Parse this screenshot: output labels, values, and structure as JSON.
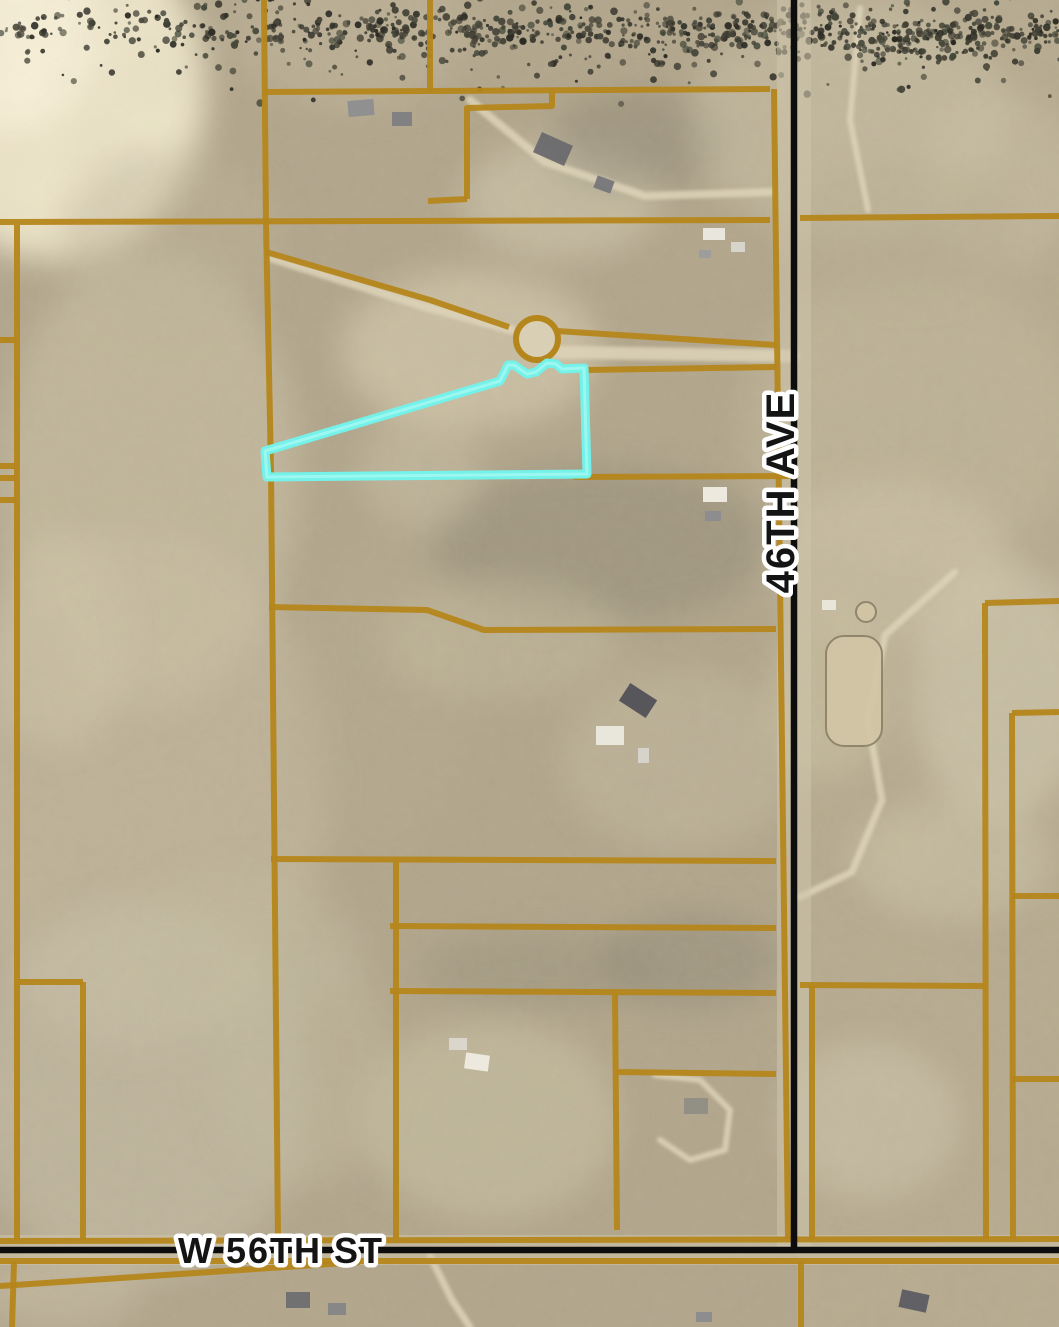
{
  "map": {
    "width": 1059,
    "height": 1327,
    "colors": {
      "terrain_base": "#b2a68c",
      "east_tint": "#c8bda0",
      "parcel_line": "#b5861b",
      "subject_outline": "#74f2ea",
      "subject_outline_inner": "#aefaf4",
      "road_black": "#0d0d0d",
      "pavement": "#cdc5ab",
      "dirt_path": "#ddd3b8",
      "culdesac_fill": "#d9cfb4",
      "label_fill": "#141414",
      "label_halo": "#ffffff",
      "arena_fill": "#d2c6a6",
      "arena_edge": "#8a8168"
    },
    "roads": {
      "ave": {
        "label": "46TH AVE",
        "x": 794,
        "y_start": 0,
        "y_end": 1253,
        "line_width": 6.5,
        "label_x": 794,
        "label_y": 492,
        "label_size": 40
      },
      "st": {
        "label": "W 56TH ST",
        "y": 1250,
        "x_start": 0,
        "x_end": 1059,
        "line_width": 6.5,
        "label_x": 178,
        "label_y": 1263,
        "label_size": 36
      }
    },
    "subject_parcel": {
      "points": [
        [
          265,
          451
        ],
        [
          500,
          381
        ],
        [
          508,
          365
        ],
        [
          514,
          365
        ],
        [
          527,
          374
        ],
        [
          536,
          372
        ],
        [
          547,
          363
        ],
        [
          556,
          364
        ],
        [
          562,
          369
        ],
        [
          584,
          368
        ],
        [
          587,
          474
        ],
        [
          267,
          477
        ]
      ],
      "stroke_width": 9
    },
    "culdesac": {
      "cx": 537,
      "cy": 339,
      "r": 21
    },
    "arena": {
      "x": 826,
      "y": 636,
      "w": 56,
      "h": 110,
      "rx": 18,
      "pen_cx": 866,
      "pen_cy": 612,
      "pen_r": 10
    },
    "parcel_lines": [
      [
        [
          0,
          222
        ],
        [
          770,
          220
        ]
      ],
      [
        [
          800,
          218
        ],
        [
          1059,
          216
        ]
      ],
      [
        [
          264,
          0
        ],
        [
          266,
          224
        ]
      ],
      [
        [
          266,
          224
        ],
        [
          271,
          470
        ],
        [
          278,
          1240
        ]
      ],
      [
        [
          430,
          0
        ],
        [
          430,
          92
        ]
      ],
      [
        [
          264,
          92
        ],
        [
          770,
          89
        ]
      ],
      [
        [
          467,
          199
        ],
        [
          467,
          108
        ],
        [
          552,
          106
        ],
        [
          552,
          91
        ]
      ],
      [
        [
          428,
          201
        ],
        [
          467,
          199
        ]
      ],
      [
        [
          266,
          252
        ],
        [
          430,
          300
        ],
        [
          509,
          327
        ]
      ],
      [
        [
          557,
          331
        ],
        [
          776,
          345
        ]
      ],
      [
        [
          586,
          370
        ],
        [
          776,
          367
        ]
      ],
      [
        [
          573,
          477
        ],
        [
          794,
          476
        ]
      ],
      [
        [
          774,
          89
        ],
        [
          788,
          1239
        ]
      ],
      [
        [
          269,
          607
        ],
        [
          427,
          610
        ],
        [
          484,
          630
        ],
        [
          776,
          629
        ]
      ],
      [
        [
          271,
          859
        ],
        [
          776,
          861
        ]
      ],
      [
        [
          390,
          926
        ],
        [
          776,
          928
        ]
      ],
      [
        [
          396,
          861
        ],
        [
          396,
          1238
        ]
      ],
      [
        [
          390,
          991
        ],
        [
          776,
          993
        ]
      ],
      [
        [
          615,
          994
        ],
        [
          617,
          1230
        ]
      ],
      [
        [
          617,
          1072
        ],
        [
          776,
          1074
        ]
      ],
      [
        [
          0,
          1241
        ],
        [
          1059,
          1239
        ]
      ],
      [
        [
          0,
          1261
        ],
        [
          1059,
          1261
        ]
      ],
      [
        [
          0,
          1286
        ],
        [
          360,
          1262
        ]
      ],
      [
        [
          14,
          1262
        ],
        [
          12,
          1327
        ]
      ],
      [
        [
          801,
          1262
        ],
        [
          801,
          1327
        ]
      ],
      [
        [
          985,
          603
        ],
        [
          1059,
          601
        ]
      ],
      [
        [
          985,
          603
        ],
        [
          986,
          1239
        ]
      ],
      [
        [
          1012,
          713
        ],
        [
          1059,
          712
        ]
      ],
      [
        [
          1012,
          713
        ],
        [
          1013,
          1239
        ]
      ],
      [
        [
          1012,
          896
        ],
        [
          1059,
          896
        ]
      ],
      [
        [
          1012,
          1079
        ],
        [
          1059,
          1079
        ]
      ],
      [
        [
          800,
          985
        ],
        [
          985,
          986
        ]
      ],
      [
        [
          812,
          986
        ],
        [
          812,
          1239
        ]
      ],
      [
        [
          0,
          340
        ],
        [
          17,
          340
        ]
      ],
      [
        [
          0,
          466
        ],
        [
          17,
          466
        ]
      ],
      [
        [
          0,
          478
        ],
        [
          17,
          478
        ]
      ],
      [
        [
          0,
          500
        ],
        [
          17,
          500
        ]
      ],
      [
        [
          17,
          225
        ],
        [
          17,
          1241
        ]
      ],
      [
        [
          18,
          982
        ],
        [
          83,
          982
        ]
      ],
      [
        [
          83,
          982
        ],
        [
          83,
          1240
        ]
      ]
    ],
    "paths": [
      {
        "pts": [
          [
            272,
            258
          ],
          [
            420,
            305
          ],
          [
            512,
            330
          ]
        ],
        "w": 9
      },
      {
        "pts": [
          [
            549,
            352
          ],
          [
            793,
            356
          ]
        ],
        "w": 13
      },
      {
        "pts": [
          [
            470,
            100
          ],
          [
            545,
            162
          ],
          [
            645,
            196
          ],
          [
            772,
            192
          ]
        ],
        "w": 8
      },
      {
        "pts": [
          [
            955,
            572
          ],
          [
            885,
            635
          ],
          [
            868,
            720
          ],
          [
            882,
            800
          ],
          [
            852,
            872
          ],
          [
            800,
            897
          ]
        ],
        "w": 7
      },
      {
        "pts": [
          [
            860,
            8
          ],
          [
            850,
            120
          ],
          [
            868,
            210
          ]
        ],
        "w": 6
      },
      {
        "pts": [
          [
            655,
            1075
          ],
          [
            700,
            1080
          ],
          [
            730,
            1110
          ],
          [
            725,
            1150
          ],
          [
            690,
            1160
          ],
          [
            660,
            1140
          ]
        ],
        "w": 6
      },
      {
        "pts": [
          [
            430,
            1256
          ],
          [
            452,
            1300
          ],
          [
            470,
            1327
          ]
        ],
        "w": 7
      }
    ],
    "patches": [
      [
        55,
        90,
        150,
        170,
        "#efe7cb",
        0.95
      ],
      [
        10,
        30,
        90,
        100,
        "#f7f0d8",
        0.9
      ],
      [
        150,
        480,
        150,
        230,
        "#cfc5a9",
        0.5
      ],
      [
        140,
        790,
        190,
        260,
        "#cbc2a7",
        0.45
      ],
      [
        140,
        1090,
        170,
        190,
        "#c9c2ab",
        0.5
      ],
      [
        470,
        350,
        130,
        80,
        "#d8cfb3",
        0.6
      ],
      [
        560,
        200,
        100,
        60,
        "#d6cdb4",
        0.5
      ],
      [
        640,
        140,
        90,
        50,
        "#8f8776",
        0.5
      ],
      [
        600,
        545,
        170,
        80,
        "#8e8774",
        0.45
      ],
      [
        910,
        420,
        170,
        150,
        "#c3b99e",
        0.5
      ],
      [
        1000,
        690,
        90,
        130,
        "#d6cdb4",
        0.55
      ],
      [
        890,
        560,
        120,
        80,
        "#cfc6ab",
        0.5
      ],
      [
        490,
        1120,
        130,
        100,
        "#cbc2a6",
        0.55
      ],
      [
        300,
        1060,
        90,
        130,
        "#c3bb9f",
        0.45
      ],
      [
        680,
        760,
        120,
        90,
        "#c9c0a5",
        0.4
      ],
      [
        380,
        700,
        90,
        160,
        "#b7ad92",
        0.4
      ],
      [
        850,
        120,
        160,
        120,
        "#cfc6ab",
        0.45
      ],
      [
        1000,
        180,
        80,
        90,
        "#c9c0a6",
        0.5
      ],
      [
        870,
        1120,
        90,
        80,
        "#cfc8b0",
        0.5
      ],
      [
        60,
        1290,
        80,
        40,
        "#c9c0a8",
        0.5
      ],
      [
        350,
        30,
        120,
        80,
        "#c3b99e",
        0.45
      ],
      [
        690,
        960,
        90,
        50,
        "#8e8775",
        0.45
      ],
      [
        540,
        970,
        120,
        40,
        "#938b78",
        0.4
      ],
      [
        240,
        950,
        120,
        80,
        "#c3bb9f",
        0.4
      ],
      [
        420,
        470,
        60,
        60,
        "#c9c0a5",
        0.5
      ],
      [
        830,
        690,
        60,
        90,
        "#c9bfa0",
        0.6
      ],
      [
        950,
        860,
        100,
        60,
        "#cfc7ac",
        0.5
      ],
      [
        170,
        240,
        110,
        90,
        "#bdb398",
        0.4
      ],
      [
        60,
        640,
        70,
        110,
        "#cfc6aa",
        0.5
      ],
      [
        500,
        640,
        120,
        60,
        "#c5bca0",
        0.45
      ],
      [
        900,
        230,
        120,
        70,
        "#b7ad92",
        0.4
      ]
    ],
    "tree_clusters": [
      [
        900,
        40,
        45,
        25,
        26
      ],
      [
        965,
        55,
        40,
        22,
        22
      ],
      [
        1025,
        45,
        35,
        20,
        18
      ],
      [
        1045,
        105,
        25,
        30,
        16
      ],
      [
        855,
        90,
        25,
        18,
        12
      ],
      [
        835,
        265,
        35,
        25,
        20
      ],
      [
        885,
        305,
        45,
        28,
        26
      ],
      [
        950,
        345,
        45,
        28,
        26
      ],
      [
        1015,
        385,
        40,
        26,
        22
      ],
      [
        1050,
        430,
        25,
        20,
        14
      ],
      [
        870,
        360,
        30,
        20,
        14
      ],
      [
        935,
        415,
        30,
        20,
        14
      ],
      [
        1040,
        990,
        18,
        35,
        20
      ],
      [
        1038,
        1055,
        16,
        40,
        22
      ],
      [
        1045,
        1115,
        16,
        30,
        16
      ],
      [
        272,
        45,
        12,
        45,
        18
      ],
      [
        350,
        115,
        30,
        18,
        14
      ],
      [
        425,
        120,
        20,
        14,
        10
      ],
      [
        330,
        250,
        35,
        15,
        12
      ],
      [
        395,
        262,
        35,
        14,
        12
      ],
      [
        455,
        275,
        30,
        14,
        10
      ],
      [
        670,
        150,
        45,
        30,
        26
      ],
      [
        715,
        205,
        30,
        22,
        16
      ],
      [
        625,
        235,
        25,
        15,
        10
      ],
      [
        470,
        555,
        40,
        25,
        20
      ],
      [
        540,
        530,
        40,
        28,
        22
      ],
      [
        610,
        505,
        40,
        28,
        22
      ],
      [
        680,
        480,
        40,
        25,
        20
      ],
      [
        645,
        565,
        35,
        22,
        16
      ],
      [
        730,
        525,
        30,
        22,
        16
      ],
      [
        755,
        575,
        25,
        18,
        12
      ],
      [
        705,
        600,
        25,
        15,
        10
      ],
      [
        310,
        645,
        18,
        30,
        14
      ],
      [
        330,
        710,
        18,
        35,
        16
      ],
      [
        350,
        780,
        18,
        35,
        16
      ],
      [
        365,
        850,
        16,
        30,
        14
      ],
      [
        378,
        915,
        14,
        25,
        12
      ],
      [
        625,
        645,
        35,
        18,
        14
      ],
      [
        690,
        655,
        30,
        15,
        10
      ],
      [
        510,
        795,
        35,
        20,
        16
      ],
      [
        570,
        820,
        35,
        20,
        16
      ],
      [
        625,
        835,
        30,
        18,
        12
      ],
      [
        470,
        760,
        25,
        18,
        10
      ],
      [
        470,
        950,
        35,
        18,
        14
      ],
      [
        560,
        950,
        40,
        18,
        16
      ],
      [
        640,
        950,
        35,
        18,
        14
      ],
      [
        720,
        945,
        30,
        18,
        12
      ],
      [
        420,
        1005,
        20,
        12,
        8
      ],
      [
        600,
        1020,
        25,
        12,
        8
      ],
      [
        125,
        1200,
        30,
        14,
        18
      ],
      [
        185,
        1202,
        30,
        14,
        18
      ],
      [
        240,
        1202,
        28,
        14,
        16
      ],
      [
        90,
        1190,
        18,
        12,
        10
      ],
      [
        870,
        1060,
        60,
        60,
        60
      ],
      [
        930,
        1140,
        55,
        60,
        55
      ],
      [
        860,
        1180,
        45,
        45,
        40
      ],
      [
        940,
        1030,
        40,
        35,
        30
      ],
      [
        830,
        1110,
        30,
        50,
        30
      ],
      [
        510,
        1300,
        40,
        18,
        16
      ],
      [
        580,
        1312,
        40,
        16,
        16
      ],
      [
        650,
        1318,
        35,
        14,
        12
      ],
      [
        915,
        1300,
        45,
        25,
        22
      ],
      [
        460,
        1290,
        20,
        12,
        8
      ],
      [
        820,
        800,
        15,
        40,
        14
      ],
      [
        812,
        880,
        12,
        25,
        10
      ],
      [
        170,
        130,
        30,
        20,
        8
      ],
      [
        90,
        420,
        15,
        25,
        8
      ],
      [
        45,
        540,
        12,
        20,
        6
      ],
      [
        660,
        1100,
        25,
        15,
        10
      ],
      [
        745,
        1140,
        20,
        15,
        8
      ],
      [
        700,
        1230,
        25,
        15,
        10
      ],
      [
        560,
        1240,
        30,
        10,
        8
      ],
      [
        430,
        485,
        70,
        12,
        16
      ],
      [
        540,
        490,
        40,
        10,
        10
      ],
      [
        745,
        70,
        20,
        15,
        8
      ],
      [
        600,
        60,
        25,
        15,
        6
      ]
    ],
    "buildings": [
      [
        348,
        100,
        26,
        16,
        "#8e8e90",
        -5
      ],
      [
        392,
        112,
        20,
        14,
        "#7e7e82",
        0
      ],
      [
        536,
        138,
        34,
        22,
        "#6a6a6e",
        24
      ],
      [
        595,
        178,
        18,
        13,
        "#76767a",
        20
      ],
      [
        703,
        228,
        22,
        12,
        "#eceae2",
        0
      ],
      [
        731,
        242,
        14,
        10,
        "#d9d7cf",
        0
      ],
      [
        699,
        250,
        12,
        8,
        "#9c9c9e",
        0
      ],
      [
        703,
        487,
        24,
        15,
        "#f0ede3",
        0
      ],
      [
        705,
        511,
        16,
        10,
        "#8c8c90",
        0
      ],
      [
        622,
        690,
        32,
        21,
        "#515157",
        33
      ],
      [
        596,
        726,
        28,
        19,
        "#ebe9df",
        0
      ],
      [
        638,
        748,
        11,
        15,
        "#d7d5cc",
        0
      ],
      [
        449,
        1038,
        18,
        12,
        "#dbd8cd",
        0
      ],
      [
        465,
        1054,
        24,
        16,
        "#f0ece2",
        8
      ],
      [
        684,
        1098,
        24,
        16,
        "#908d85",
        0
      ],
      [
        822,
        600,
        14,
        10,
        "#eae7dc",
        0
      ],
      [
        286,
        1292,
        24,
        16,
        "#6e6e70",
        0
      ],
      [
        328,
        1303,
        18,
        12,
        "#858587",
        0
      ],
      [
        900,
        1292,
        28,
        18,
        "#5c5c62",
        12
      ],
      [
        696,
        1312,
        16,
        10,
        "#8b8b8d",
        0
      ]
    ],
    "tree_palette": [
      "#3f3d32",
      "#32312a",
      "#4a473a",
      "#2b2b24",
      "#44483a"
    ]
  }
}
